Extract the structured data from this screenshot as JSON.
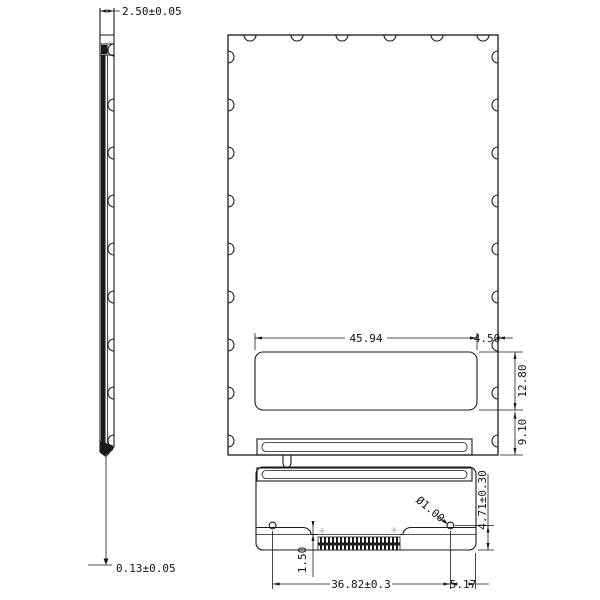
{
  "dimensions": {
    "side_width": "2.50±0.05",
    "film_thickness": "0.13±0.05",
    "window_width": "45.94",
    "window_right_margin": "4.50",
    "window_height": "12.80",
    "window_bottom_margin": "9.10",
    "fpc_hole_to_bottom": "4.71±0.30",
    "fpc_step_height": "1.50",
    "fpc_hole_spacing": "36.82±0.3",
    "fpc_hole_to_edge": "5.17",
    "fpc_hole_diameter": "Ø1.00"
  }
}
